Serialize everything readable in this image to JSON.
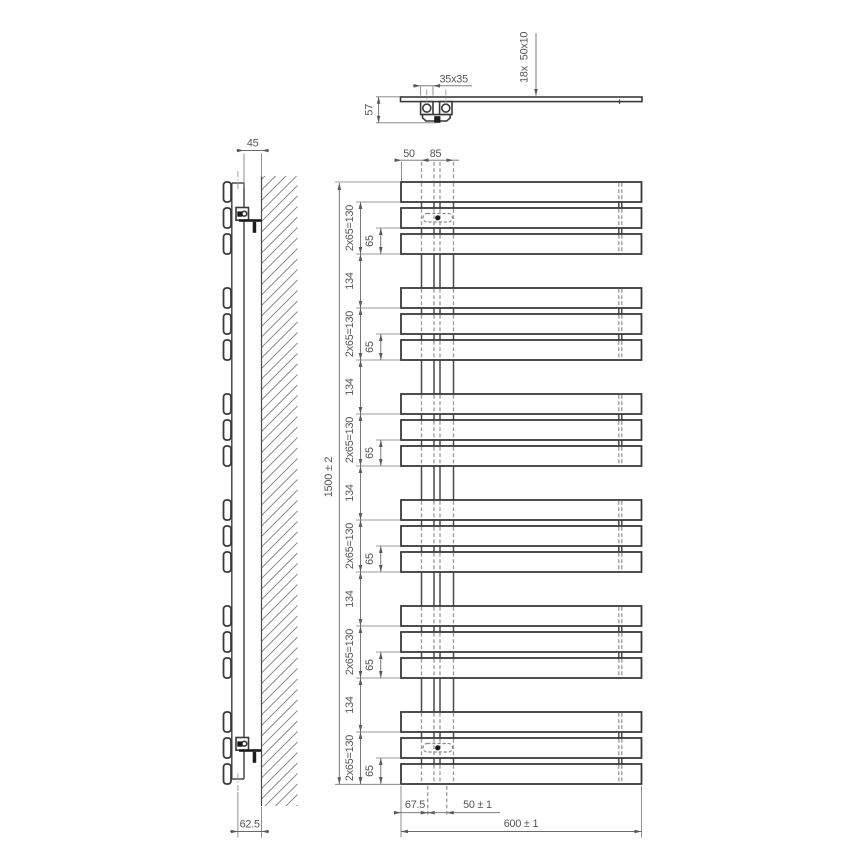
{
  "page": {
    "background": "#ffffff"
  },
  "drawing": {
    "type": "technical-drawing",
    "subject": "towel-radiator-three-views",
    "colors": {
      "outline": "#3a3a3a",
      "dimension": "#6a6a6a",
      "text": "#555555",
      "hidden_line": "#999999",
      "black_fill": "#1b1b1b"
    },
    "views": {
      "top_view": {
        "plate_size": "35x35",
        "bracket_depth": "57",
        "bar_count_label": "18x",
        "bar_profile_label": "50x10"
      },
      "side_view": {
        "wall_clearance": "45",
        "bottom_wall_offset": "62.5"
      },
      "front_view": {
        "left_edge_to_collector": "50",
        "collector_spacing": "85",
        "overall_height": "1500 ± 2",
        "bar_group_spacing": "2x65=130",
        "group_gap": "134",
        "bar_spacing": "65",
        "bottom_edge_to_collector": "67.5",
        "bottom_collector_spacing": "50 ± 1",
        "overall_width": "600 ± 1",
        "bar_count": 18,
        "bar_groups": 6,
        "bars_per_group": 3
      }
    }
  }
}
